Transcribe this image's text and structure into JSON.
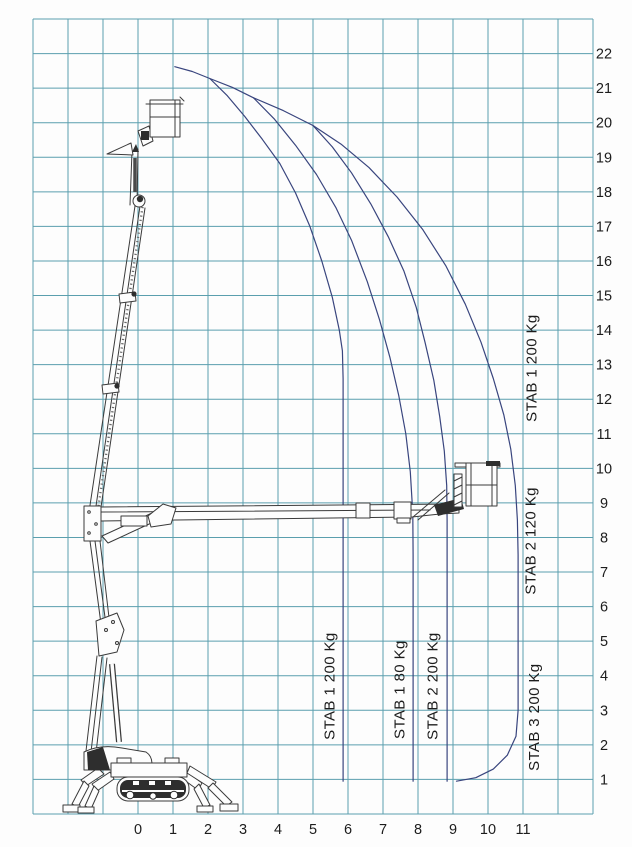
{
  "page": {
    "background": "#fdfdfd"
  },
  "colors": {
    "grid": "#5b9fae",
    "curve": "#39457e",
    "ink": "#1c1c1c",
    "machine_line": "#3a3a3a"
  },
  "chart_data": {
    "type": "line",
    "title": "",
    "xlabel": "",
    "ylabel": "",
    "xlim": [
      -3,
      13
    ],
    "ylim": [
      0,
      23
    ],
    "grid": true,
    "x_ticks": [
      0,
      1,
      2,
      3,
      4,
      5,
      6,
      7,
      8,
      9,
      10,
      11
    ],
    "y_ticks": [
      1,
      2,
      3,
      4,
      5,
      6,
      7,
      8,
      9,
      10,
      11,
      12,
      13,
      14,
      15,
      16,
      17,
      18,
      19,
      20,
      21,
      22
    ],
    "series": [
      {
        "name": "envelope-top",
        "points": [
          [
            1.05,
            21.62
          ],
          [
            1.55,
            21.48
          ],
          [
            2.05,
            21.28
          ],
          [
            2.7,
            21.02
          ],
          [
            3.3,
            20.72
          ],
          [
            4.15,
            20.35
          ],
          [
            5.0,
            19.92
          ]
        ]
      },
      {
        "name": "limit-stab1-200kg",
        "points": [
          [
            2.05,
            21.28
          ],
          [
            2.55,
            20.78
          ],
          [
            3.05,
            20.18
          ],
          [
            3.55,
            19.52
          ],
          [
            4.05,
            18.82
          ],
          [
            4.5,
            17.97
          ],
          [
            4.91,
            17.0
          ],
          [
            5.25,
            16.0
          ],
          [
            5.55,
            14.95
          ],
          [
            5.75,
            14.0
          ],
          [
            5.84,
            13.4
          ],
          [
            5.86,
            12.6
          ],
          [
            5.86,
            0.95
          ]
        ]
      },
      {
        "name": "limit-stab1-80kg",
        "points": [
          [
            3.3,
            20.72
          ],
          [
            3.9,
            20.1
          ],
          [
            4.5,
            19.35
          ],
          [
            5.1,
            18.5
          ],
          [
            5.65,
            17.55
          ],
          [
            6.1,
            16.6
          ],
          [
            6.55,
            15.4
          ],
          [
            6.9,
            14.3
          ],
          [
            7.2,
            13.2
          ],
          [
            7.45,
            12.1
          ],
          [
            7.65,
            11.0
          ],
          [
            7.78,
            9.9
          ],
          [
            7.85,
            8.7
          ],
          [
            7.86,
            7.5
          ],
          [
            7.86,
            0.95
          ]
        ]
      },
      {
        "name": "limit-stab2-200kg",
        "points": [
          [
            5.0,
            19.92
          ],
          [
            5.55,
            19.3
          ],
          [
            6.1,
            18.55
          ],
          [
            6.65,
            17.65
          ],
          [
            7.15,
            16.7
          ],
          [
            7.6,
            15.7
          ],
          [
            7.95,
            14.65
          ],
          [
            8.2,
            13.65
          ],
          [
            8.45,
            12.55
          ],
          [
            8.62,
            11.5
          ],
          [
            8.75,
            10.5
          ],
          [
            8.82,
            9.5
          ],
          [
            8.83,
            8.5
          ],
          [
            8.83,
            0.95
          ]
        ]
      },
      {
        "name": "outer-envelope-stab2-120kg-stab3-200kg",
        "points": [
          [
            5.0,
            19.92
          ],
          [
            5.8,
            19.38
          ],
          [
            6.6,
            18.7
          ],
          [
            7.4,
            17.85
          ],
          [
            8.14,
            16.9
          ],
          [
            8.8,
            15.85
          ],
          [
            9.35,
            14.75
          ],
          [
            9.8,
            13.65
          ],
          [
            10.15,
            12.6
          ],
          [
            10.45,
            11.55
          ],
          [
            10.65,
            10.55
          ],
          [
            10.78,
            9.5
          ],
          [
            10.84,
            8.5
          ],
          [
            10.86,
            7.5
          ],
          [
            10.86,
            3.0
          ],
          [
            10.8,
            2.25
          ],
          [
            10.55,
            1.7
          ],
          [
            10.15,
            1.3
          ],
          [
            9.65,
            1.05
          ],
          [
            9.1,
            0.95
          ]
        ]
      }
    ],
    "annotations": [
      {
        "text": "STAB 1  200 Kg",
        "x": 5.62,
        "y": 3.7,
        "rotation": -90
      },
      {
        "text": "STAB 1  80 Kg",
        "x": 7.62,
        "y": 3.6,
        "rotation": -90
      },
      {
        "text": "STAB 2  200 Kg",
        "x": 8.55,
        "y": 3.7,
        "rotation": -90
      },
      {
        "text": "STAB 1  200 Kg",
        "x": 11.38,
        "y": 12.9,
        "rotation": -90
      },
      {
        "text": "STAB 2  120 Kg",
        "x": 11.35,
        "y": 7.9,
        "rotation": -90
      },
      {
        "text": "STAB 3  200 Kg",
        "x": 11.45,
        "y": 2.8,
        "rotation": -90
      }
    ]
  }
}
